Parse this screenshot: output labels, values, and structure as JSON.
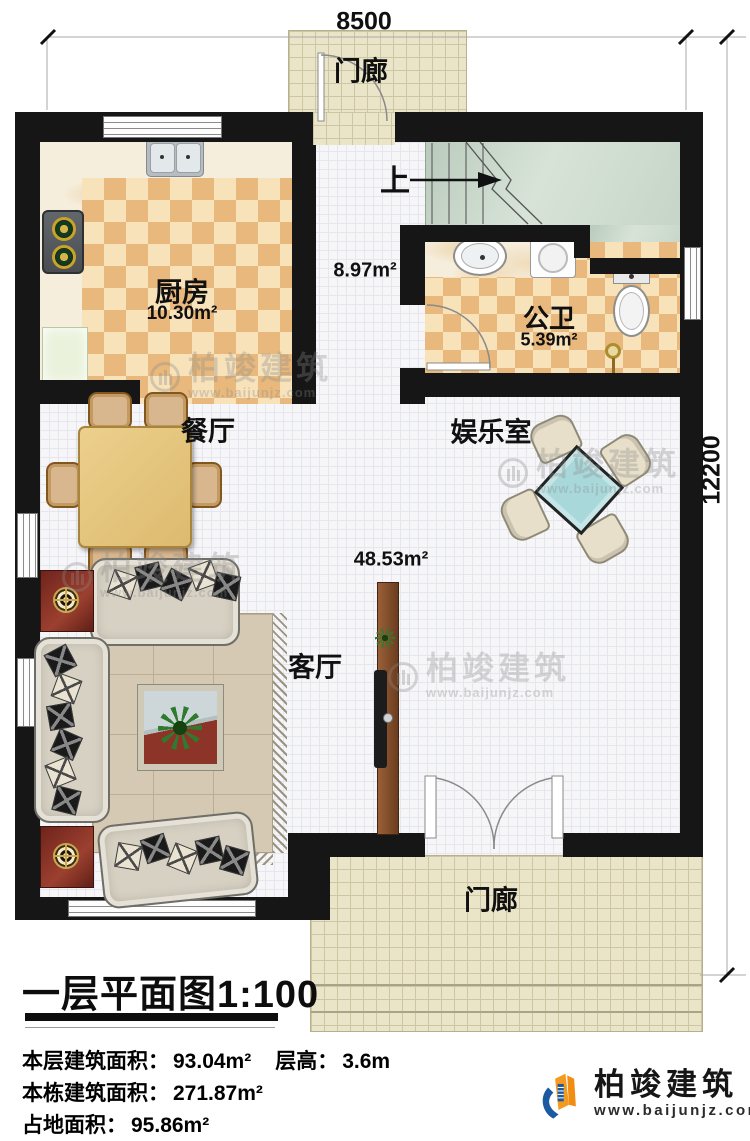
{
  "plan": {
    "dimension_width": "8500",
    "dimension_height": "12200"
  },
  "rooms": {
    "porch_top": "门廊",
    "porch_bottom": "门廊",
    "kitchen": "厨房",
    "kitchen_area": "10.30m²",
    "hall_area": "8.97m²",
    "stairs_up": "上",
    "bathroom": "公卫",
    "bathroom_area": "5.39m²",
    "dining": "餐厅",
    "entertainment": "娱乐室",
    "living": "客厅",
    "living_area": "48.53m²"
  },
  "title_block": {
    "title": "一层平面图1:100",
    "floor_area_label": "本层建筑面积：",
    "floor_area_value": "93.04m²",
    "floor_height_label": "层高：",
    "floor_height_value": "3.6m",
    "building_area_label": "本栋建筑面积：",
    "building_area_value": "271.87m²",
    "land_area_label": "占地面积：",
    "land_area_value": "95.86m²"
  },
  "branding": {
    "company": "柏竣建筑",
    "website": "www.baijunjz.com"
  },
  "watermark": {
    "company": "柏竣建筑",
    "website": "www.baijunjz.com"
  },
  "icons": {
    "watermark_badge": "circled-building-icon",
    "company_logo": "building-swoosh-icon"
  },
  "colors": {
    "wall": "#161616",
    "checker_dark": "#e8b87c",
    "checker_light": "#f7e2ba",
    "stairs_floor": "#c9d7ca",
    "porch_tile": "#eae5c8",
    "mahjong_table": "#a8d8da",
    "dining_table": "#e5c47e",
    "logo_blue": "#1b5aa0",
    "logo_orange": "#f59a20"
  }
}
